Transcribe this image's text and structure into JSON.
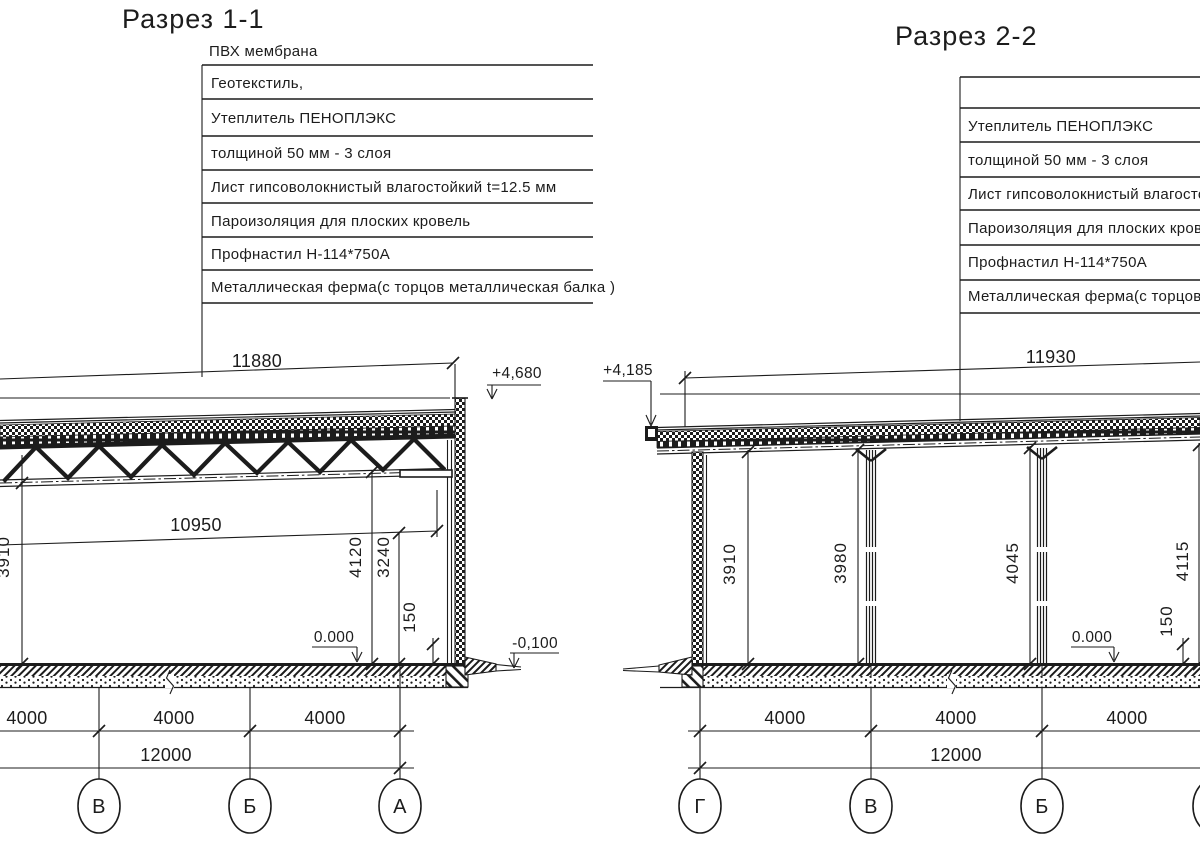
{
  "drawing": {
    "background": "#ffffff",
    "line_color": "#1c1c1c"
  },
  "section_1": {
    "title": "Разрез 1-1",
    "roof_callout": {
      "above_label": "ПВХ мембрана",
      "rows": [
        "Геотекстиль,",
        "Утеплитель ПЕНОПЛЭКС",
        "толщиной 50 мм - 3 слоя",
        "Лист гипсоволокнистый влагостойкий t=12.5 мм",
        "Пароизоляция для плоских кровель",
        "Профнастил Н-114*750А",
        "Металлическая ферма(с торцов металлическая балка )"
      ]
    },
    "dimensions": {
      "roof_span": "11880",
      "clear_span": "10950",
      "height_left": "3910",
      "height_right_outer": "4120",
      "height_right_inner": "3240",
      "plinth": "150",
      "bays": [
        "4000",
        "4000",
        "4000"
      ],
      "total": "12000"
    },
    "levels": {
      "roof_top": "+4,680",
      "floor": "0.000",
      "ground": "-0,100"
    },
    "axes": [
      "В",
      "Б",
      "А"
    ]
  },
  "section_2": {
    "title": "Разрез 2-2",
    "roof_callout": {
      "rows": [
        "",
        "Утеплитель ПЕНОПЛЭКС",
        "толщиной 50 мм - 3 слоя",
        "Лист гипсоволокнистый влагостойкий",
        "Пароизоляция для плоских кровель",
        "Профнастил Н-114*750А",
        "Металлическая ферма(с торцов м"
      ]
    },
    "dimensions": {
      "roof_span": "11930",
      "height_axis_g": "3910",
      "height_axis_v": "3980",
      "height_axis_b": "4045",
      "height_axis_a": "4115",
      "plinth": "150",
      "bays": [
        "4000",
        "4000",
        "4000"
      ],
      "total": "12000"
    },
    "levels": {
      "roof_top": "+4,185",
      "floor": "0.000"
    },
    "axes": [
      "Г",
      "В",
      "Б"
    ]
  }
}
